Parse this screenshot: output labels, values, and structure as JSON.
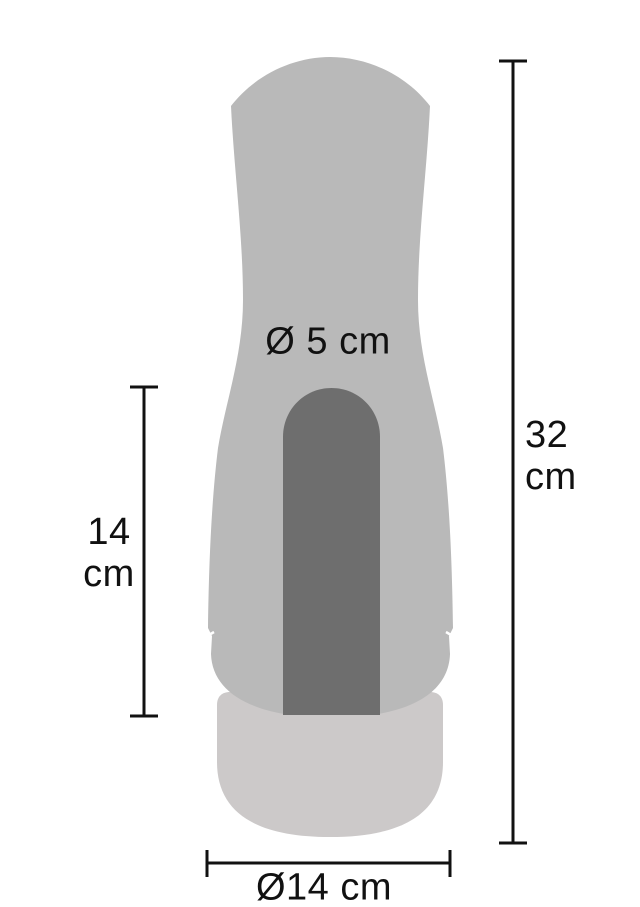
{
  "diagram": {
    "type": "product-dimension-diagram",
    "colors": {
      "body": "#b9b9b9",
      "slot": "#6e6e6e",
      "base": "#ccc9c9",
      "line": "#111111"
    },
    "dimensions": {
      "opening_diameter_label": "Ø 5 cm",
      "total_height_value": "32",
      "total_height_unit": "cm",
      "insertion_depth_value": "14",
      "insertion_depth_unit": "cm",
      "base_diameter_label": "Ø14 cm"
    }
  }
}
